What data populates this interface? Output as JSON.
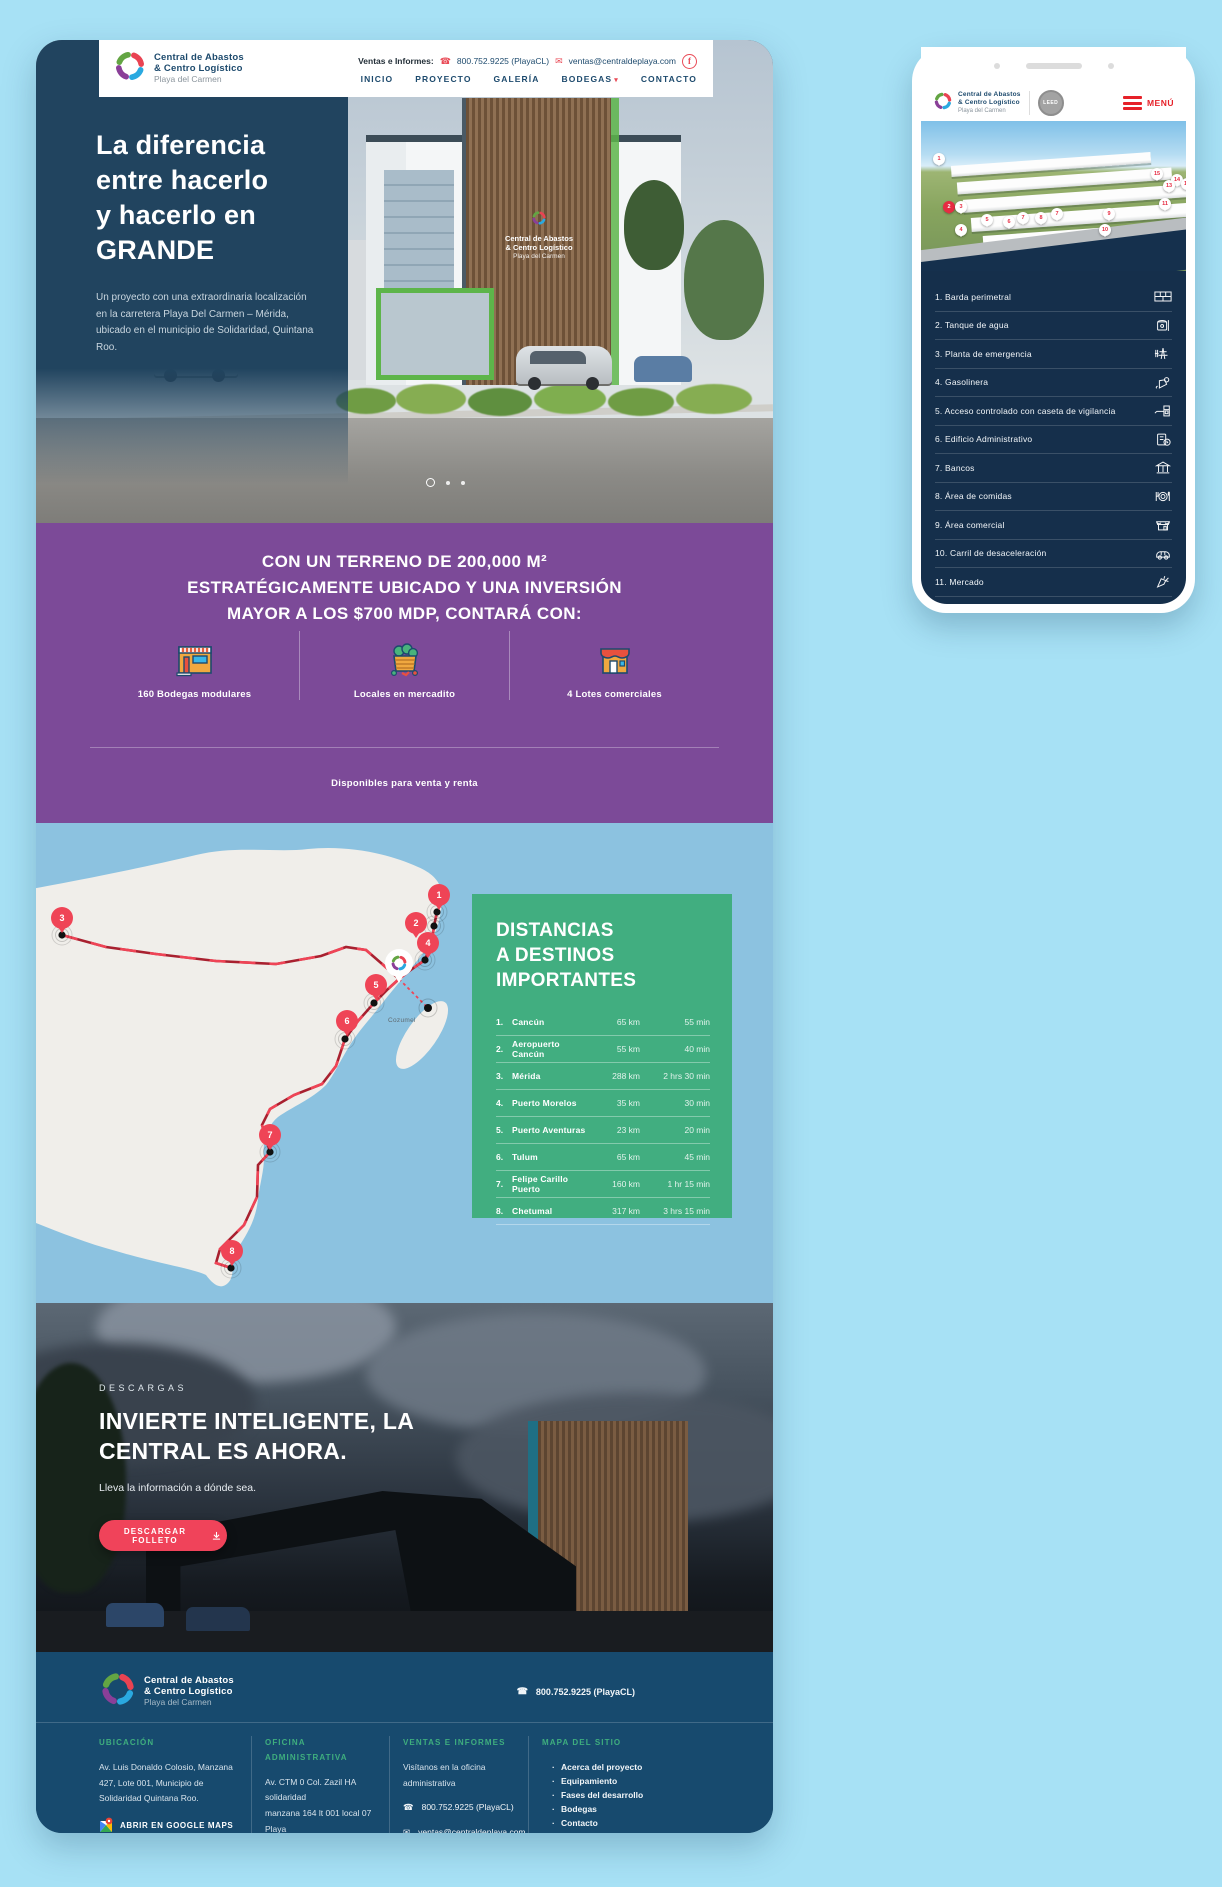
{
  "desktop": {
    "header": {
      "logo": {
        "line1": "Central de Abastos",
        "line2": "& Centro Logístico",
        "sub": "Playa del Carmen"
      },
      "contact_label": "Ventas e Informes:",
      "phone": "800.752.9225 (PlayaCL)",
      "email": "ventas@centraldeplaya.com",
      "facebook": "f",
      "nav": [
        {
          "label": "INICIO",
          "dropdown": false
        },
        {
          "label": "PROYECTO",
          "dropdown": false
        },
        {
          "label": "GALERÍA",
          "dropdown": false
        },
        {
          "label": "BODEGAS",
          "dropdown": true
        },
        {
          "label": "CONTACTO",
          "dropdown": false
        }
      ]
    },
    "hero": {
      "title_lines": [
        "La diferencia",
        "entre hacerlo",
        "y hacerlo en",
        "GRANDE"
      ],
      "description": "Un proyecto con una extraordinaria localización en la carretera Playa Del Carmen – Mérida, ubicado en el municipio de Solidaridad, Quintana Roo.",
      "sign": {
        "line1": "Central de Abastos",
        "line2": "& Centro Logístico",
        "line3": "Playa del Carmen"
      }
    },
    "stats": {
      "heading_lines": [
        "CON UN TERRENO DE 200,000 M²",
        "ESTRATÉGICAMENTE UBICADO Y UNA INVERSIÓN",
        "MAYOR A LOS $700 MDP, CONTARÁ CON:"
      ],
      "items": [
        {
          "icon": "warehouse",
          "label": "160 Bodegas modulares"
        },
        {
          "icon": "market-crate",
          "label": "Locales en mercadito"
        },
        {
          "icon": "store",
          "label": "4 Lotes comerciales"
        }
      ],
      "footnote": "Disponibles para venta y renta"
    },
    "map": {
      "title_lines": [
        "DISTANCIAS",
        "A DESTINOS",
        "IMPORTANTES"
      ],
      "island_label": "Cozumel",
      "rows": [
        {
          "num": "1.",
          "name": "Cancún",
          "dist": "65 km",
          "time": "55 min"
        },
        {
          "num": "2.",
          "name": "Aeropuerto Cancún",
          "dist": "55 km",
          "time": "40 min"
        },
        {
          "num": "3.",
          "name": "Mérida",
          "dist": "288 km",
          "time": "2 hrs 30 min"
        },
        {
          "num": "4.",
          "name": "Puerto Morelos",
          "dist": "35 km",
          "time": "30 min"
        },
        {
          "num": "5.",
          "name": "Puerto Aventuras",
          "dist": "23 km",
          "time": "20 min"
        },
        {
          "num": "6.",
          "name": "Tulum",
          "dist": "65 km",
          "time": "45 min"
        },
        {
          "num": "7.",
          "name": "Felipe Carillo Puerto",
          "dist": "160 km",
          "time": "1 hr 15 min"
        },
        {
          "num": "8.",
          "name": "Chetumal",
          "dist": "317 km",
          "time": "3 hrs 15 min"
        }
      ]
    },
    "downloads": {
      "eyebrow": "DESCARGAS",
      "title_lines": [
        "INVIERTE INTELIGENTE, LA",
        "CENTRAL ES AHORA."
      ],
      "subtitle": "Lleva la información a dónde sea.",
      "button_label": "DESCARGAR FOLLETO"
    },
    "footer": {
      "logo": {
        "line1": "Central de Abastos",
        "line2": "& Centro Logístico",
        "sub": "Playa del Carmen"
      },
      "phone": "800.752.9225 (PlayaCL)",
      "col1": {
        "heading": "UBICACIÓN",
        "address": "Av. Luis Donaldo Colosio, Manzana\n427, Lote 001, Municipio de\nSolidaridad Quintana Roo.",
        "button_label": "ABRIR EN GOOGLE MAPS"
      },
      "col2": {
        "heading": "OFICINA ADMINISTRATIVA",
        "address": "Av. CTM 0 Col. Zazil HA solidaridad\nmanzana 164 lt 001 local 07 Playa\ndel Carmen, Quintana Roo",
        "button_label": "ABRIR EN GOOGLE MAPS"
      },
      "col3": {
        "heading": "VENTAS E INFORMES",
        "text": "Visítanos en la oficina\nadministrativa",
        "phone": "800.752.9225 (PlayaCL)",
        "email": "ventas@centraldeplaya.com",
        "social": "/centraldeplaya"
      },
      "col4": {
        "heading": "MAPA DEL SITIO",
        "links": [
          "Acerca del proyecto",
          "Equipamiento",
          "Fases del desarrollo",
          "Bodegas",
          "Contacto"
        ]
      }
    }
  },
  "mobile": {
    "header": {
      "logo": {
        "line1": "Central de Abastos",
        "line2": "& Centro Logístico",
        "sub": "Playa del Carmen"
      },
      "badge": "LEED",
      "menu_label": "MENÚ"
    },
    "aerial_pins": [
      "1",
      "2",
      "3",
      "4",
      "5",
      "6",
      "7",
      "8",
      "7",
      "9",
      "10",
      "11",
      "15",
      "14",
      "13",
      "12"
    ],
    "list": [
      {
        "label": "1. Barda perimetral",
        "icon": "brick-wall"
      },
      {
        "label": "2. Tanque de agua",
        "icon": "water-tank"
      },
      {
        "label": "3. Planta de emergencia",
        "icon": "power-plant"
      },
      {
        "label": "4. Gasolinera",
        "icon": "fuel"
      },
      {
        "label": "5. Acceso controlado con caseta de vigilancia",
        "icon": "guard-booth"
      },
      {
        "label": "6. Edificio Administrativo",
        "icon": "admin-building"
      },
      {
        "label": "7. Bancos",
        "icon": "bank"
      },
      {
        "label": "8. Área de comidas",
        "icon": "food"
      },
      {
        "label": "9. Área comercial",
        "icon": "store-front"
      },
      {
        "label": "10. Carril de desaceleración",
        "icon": "car"
      },
      {
        "label": "11. Mercado",
        "icon": "carrot"
      },
      {
        "label": "12. Área industrial",
        "icon": "factory"
      }
    ]
  },
  "colors": {
    "accent_red": "#e94b57",
    "bright_red": "#e62129",
    "purple": "#7c4a98",
    "green_panel": "#41ae80",
    "navy": "#174a6e",
    "hero_navy": "#21445f",
    "map_water": "#8cc2e0",
    "page_bg": "#a7e1f5"
  }
}
